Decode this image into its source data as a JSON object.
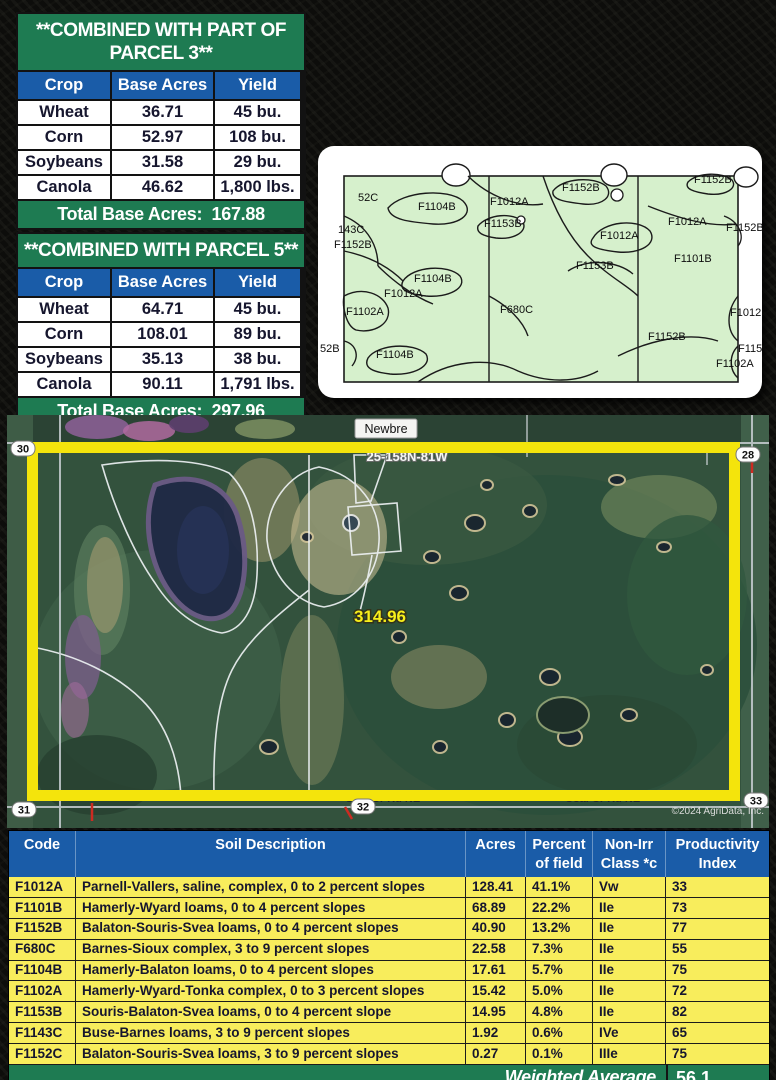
{
  "colors": {
    "green": "#1E7B52",
    "blue": "#1A5CA8",
    "row_yellow": "#F8ED5C",
    "map_green": "#D6F0CC",
    "highlight_yellow": "#F4E40C"
  },
  "crop_tables": [
    {
      "title": "**COMBINED WITH PART OF PARCEL 3**",
      "columns": [
        "Crop",
        "Base Acres",
        "Yield"
      ],
      "rows": [
        [
          "Wheat",
          "36.71",
          "45 bu."
        ],
        [
          "Corn",
          "52.97",
          "108 bu."
        ],
        [
          "Soybeans",
          "31.58",
          "29 bu."
        ],
        [
          "Canola",
          "46.62",
          "1,800 lbs."
        ]
      ],
      "footer": "Total Base Acres:  167.88"
    },
    {
      "title": "**COMBINED WITH PARCEL 5**",
      "columns": [
        "Crop",
        "Base Acres",
        "Yield"
      ],
      "rows": [
        [
          "Wheat",
          "64.71",
          "45 bu."
        ],
        [
          "Corn",
          "108.01",
          "89 bu."
        ],
        [
          "Soybeans",
          "35.13",
          "38 bu."
        ],
        [
          "Canola",
          "90.11",
          "1,791 lbs."
        ]
      ],
      "footer": "Total Base Acres:  297.96"
    }
  ],
  "soil_map": {
    "labels": [
      {
        "t": "52C",
        "x": 40,
        "y": 55
      },
      {
        "t": "143C",
        "x": 20,
        "y": 87
      },
      {
        "t": "F1152B",
        "x": 16,
        "y": 102
      },
      {
        "t": "F1104B",
        "x": 100,
        "y": 64
      },
      {
        "t": "F1012A",
        "x": 172,
        "y": 59
      },
      {
        "t": "F1153B",
        "x": 166,
        "y": 81
      },
      {
        "t": "F1152B",
        "x": 244,
        "y": 45
      },
      {
        "t": "F1152B",
        "x": 376,
        "y": 37
      },
      {
        "t": "F1012A",
        "x": 350,
        "y": 79
      },
      {
        "t": "F1152B",
        "x": 408,
        "y": 85
      },
      {
        "t": "F1101B",
        "x": 356,
        "y": 116
      },
      {
        "t": "F1012A",
        "x": 282,
        "y": 93
      },
      {
        "t": "F1153B",
        "x": 258,
        "y": 123
      },
      {
        "t": "F1102A",
        "x": 28,
        "y": 169
      },
      {
        "t": "F1012A",
        "x": 66,
        "y": 151
      },
      {
        "t": "F1104B",
        "x": 96,
        "y": 136
      },
      {
        "t": "F680C",
        "x": 182,
        "y": 167
      },
      {
        "t": "52B",
        "x": 2,
        "y": 206
      },
      {
        "t": "F1104B",
        "x": 58,
        "y": 212
      },
      {
        "t": "F1152B",
        "x": 330,
        "y": 194
      },
      {
        "t": "F1012",
        "x": 412,
        "y": 170
      },
      {
        "t": "F115",
        "x": 420,
        "y": 206
      },
      {
        "t": "F1102A",
        "x": 398,
        "y": 221
      }
    ]
  },
  "aerial": {
    "town_label": "Newbre",
    "section_label": "25-158N-81W",
    "area_label": "314.96",
    "road_label": "Coal Cr Rd NE",
    "copyright": "©2024 AgriData, Inc.",
    "corners": {
      "tl": "30",
      "tr": "28",
      "bl": "31",
      "bc": "32",
      "br": "33"
    }
  },
  "soil_table": {
    "columns": [
      "Code",
      "Soil Description",
      "Acres",
      "Percent\nof field",
      "Non-Irr\nClass *c",
      "Productivity\nIndex"
    ],
    "rows": [
      [
        "F1012A",
        "Parnell-Vallers, saline, complex, 0 to 2 percent slopes",
        "128.41",
        "41.1%",
        "Vw",
        "33"
      ],
      [
        "F1101B",
        "Hamerly-Wyard loams, 0 to 4 percent slopes",
        "68.89",
        "22.2%",
        "IIe",
        "73"
      ],
      [
        "F1152B",
        "Balaton-Souris-Svea loams, 0 to 4 percent slopes",
        "40.90",
        "13.2%",
        "IIe",
        "77"
      ],
      [
        "F680C",
        "Barnes-Sioux complex, 3 to 9 percent slopes",
        "22.58",
        "7.3%",
        "IIe",
        "55"
      ],
      [
        "F1104B",
        "Hamerly-Balaton loams, 0 to 4 percent slopes",
        "17.61",
        "5.7%",
        "IIe",
        "75"
      ],
      [
        "F1102A",
        "Hamerly-Wyard-Tonka complex, 0 to 3 percent slopes",
        "15.42",
        "5.0%",
        "IIe",
        "72"
      ],
      [
        "F1153B",
        "Souris-Balaton-Svea loams, 0 to 4 percent slope",
        "14.95",
        "4.8%",
        "IIe",
        "82"
      ],
      [
        "F1143C",
        "Buse-Barnes loams, 3 to 9 percent slopes",
        "1.92",
        "0.6%",
        "IVe",
        "65"
      ],
      [
        "F1152C",
        "Balaton-Souris-Svea loams, 3 to 9 percent slopes",
        "0.27",
        "0.1%",
        "IIIe",
        "75"
      ]
    ],
    "footer": {
      "label": "Weighted Average",
      "value": "56.1"
    }
  }
}
